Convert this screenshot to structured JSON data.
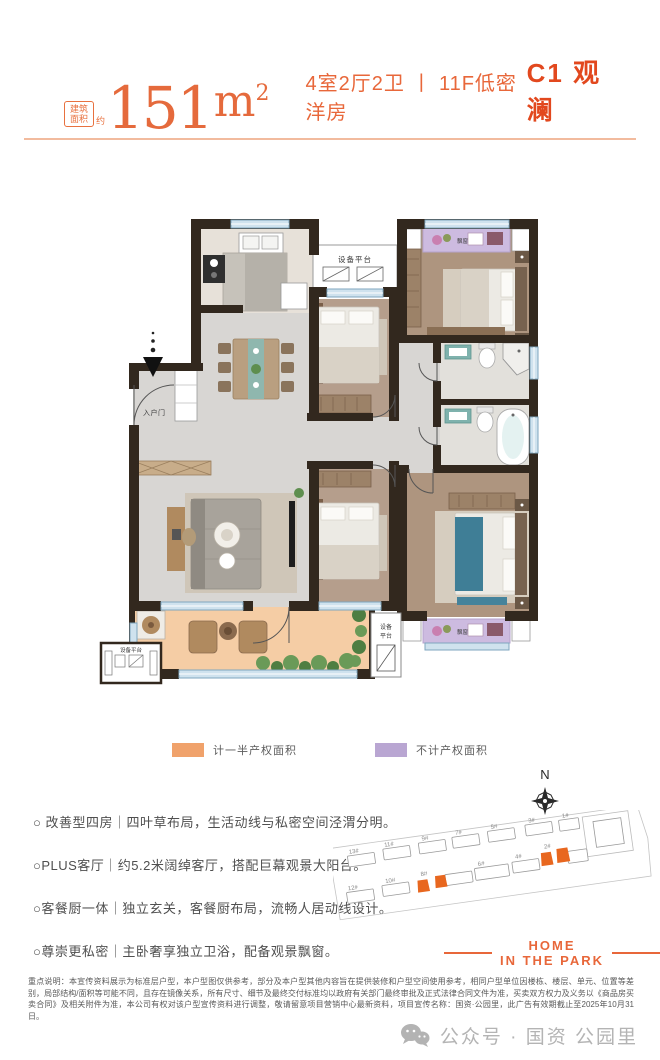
{
  "header": {
    "area_badge": "建筑面积",
    "area_badge_suffix": "约",
    "area_value": "151",
    "area_unit": "m",
    "area_exponent": "2",
    "subtitle": "4室2厅2卫 丨 11F低密洋房",
    "unit_name": "C1 观澜"
  },
  "floorplan": {
    "labels": {
      "equipment_platform": "设备平台",
      "equipment": "设备",
      "platform": "平台",
      "entry_door": "入户门",
      "bay_window": "飘窗"
    }
  },
  "legend": {
    "half_area": {
      "label": "计一半产权面积",
      "color": "#f0a26b"
    },
    "excluded_area": {
      "label": "不计产权面积",
      "color": "#b9a6d2"
    }
  },
  "compass": {
    "north": "N"
  },
  "siteplan": {
    "buildings": [
      {
        "label": "13#"
      },
      {
        "label": "11#"
      },
      {
        "label": "9#"
      },
      {
        "label": "7#"
      },
      {
        "label": "5#"
      },
      {
        "label": "3#"
      },
      {
        "label": "1#"
      },
      {
        "label": "12#"
      },
      {
        "label": "10#"
      },
      {
        "label": "8#"
      },
      {
        "label": "6#"
      },
      {
        "label": "4#"
      },
      {
        "label": "2#"
      }
    ],
    "highlight_color": "#e8671f"
  },
  "features": {
    "items": [
      "○ 改善型四房｜四叶草布局，生活动线与私密空间泾渭分明。",
      "○PLUS客厅｜约5.2米阔绰客厅，搭配巨幕观景大阳台。",
      "○客餐厨一体｜独立玄关，客餐厨布局，流畅人居动线设计。",
      "○尊崇更私密｜主卧奢享独立卫浴，配备观景飘窗。"
    ]
  },
  "brand": {
    "line1": "HOME",
    "line2": "IN THE PARK"
  },
  "disclaimer": "重点说明：本宣传资料展示为标准层户型，本户型图仅供参考，部分及本户型其他内容旨在提供装修和户型空间使用参考，相同户型单位因楼栋、楼层、单元、位置等差别，局部结构/面积等可能不同，且存在镜像关系，所有尺寸、细节及最终交付标准均以政府有关部门最终审批及正式法律合同文件为准，买卖双方权力及义务以《商品房买卖合同》及相关附件为准，本公司有权对该户型宣传资料进行调整，敬请留意项目营销中心最新资料，项目宣传名称：国资·公园里，此广告有效期截止至2025年10月31日。",
  "footer": {
    "wechat_label": "公众号 · 国资 公园里"
  },
  "colors": {
    "accent_orange": "#e8673a",
    "title_orange": "#e2481e",
    "wall": "#32281e",
    "balcony_floor": "#f5cda5",
    "bay_window_fill": "#cdbbe0",
    "bedroom_floor": "#b59e8c",
    "window_blue": "#cfe2ee"
  }
}
